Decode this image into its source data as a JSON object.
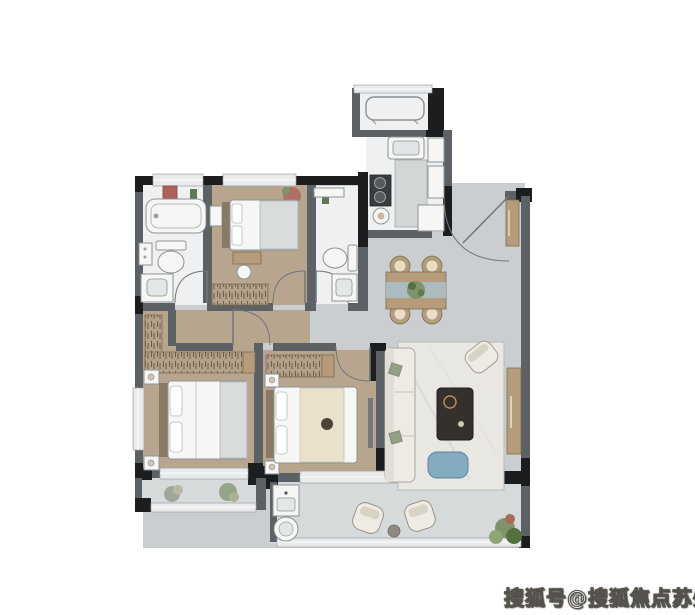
{
  "watermark": {
    "text": "搜狐号@搜狐焦点苏州站"
  },
  "colors": {
    "wall": "#5c6165",
    "wall_dark": "#1b1d1f",
    "window_glass": "#e8eaeb",
    "window_frame": "#9ba1a4",
    "floor_wood": "#b7a58e",
    "floor_tile": "#cbced1",
    "floor_bath": "#eef0f1",
    "floor_balcony": "#d7dadb",
    "furn_white": "#f6f6f4",
    "furn_stroke": "#8e9396",
    "wardrobe_bg": "#b3a189",
    "wardrobe_mark": "#6b5d4b",
    "wood_dark": "#8a7a64",
    "cabinet": "#b59d7c",
    "sofa": "#eeebe4",
    "rug": "#e9e7e3",
    "table_dark": "#35302b",
    "pouf": "#82abc0",
    "runner_blue": "#a9c2cb",
    "plant": "#7e9368",
    "plant_dark": "#55703f",
    "blanket_gray": "#d9dcdd",
    "blanket_cream": "#e9e1cc",
    "deco_red": "#b0605a",
    "bottle_green": "#5e7a52",
    "stove_dark": "#3a3d40",
    "island_gray": "#d3d6d7",
    "gold": "#b08d4f"
  },
  "plan": {
    "type": "residential-floor-plan",
    "rooms": [
      {
        "id": "equipment-balcony",
        "furniture": [
          "ac-outdoor-unit"
        ]
      },
      {
        "id": "kitchen",
        "furniture": [
          "sink",
          "stove",
          "island-counter",
          "cabinets"
        ]
      },
      {
        "id": "main-bathroom",
        "furniture": [
          "bathtub",
          "toilet",
          "vanity-sink",
          "side-cabinet"
        ]
      },
      {
        "id": "small-bedroom",
        "furniture": [
          "bed",
          "side-cabinet",
          "vanity-desk",
          "stool",
          "wardrobe"
        ]
      },
      {
        "id": "second-bathroom",
        "furniture": [
          "toilet",
          "vanity-sink",
          "shelf"
        ]
      },
      {
        "id": "foyer-dining",
        "furniture": [
          "shoe-cabinet",
          "dining-table",
          "dining-chairs",
          "plant-centerpiece"
        ]
      },
      {
        "id": "living-room",
        "furniture": [
          "sofa",
          "rug",
          "coffee-table",
          "blue-pouf",
          "accent-chair",
          "tv-cabinet"
        ]
      },
      {
        "id": "master-bedroom",
        "furniture": [
          "l-wardrobe",
          "double-bed",
          "nightstands"
        ]
      },
      {
        "id": "second-bedroom",
        "furniture": [
          "wardrobe",
          "double-bed",
          "nightstands"
        ]
      },
      {
        "id": "master-balcony",
        "furniture": [
          "plants"
        ]
      },
      {
        "id": "main-balcony",
        "furniture": [
          "laundry-cabinet",
          "round-basin",
          "lounge-chairs",
          "side-table",
          "plants"
        ]
      }
    ]
  }
}
